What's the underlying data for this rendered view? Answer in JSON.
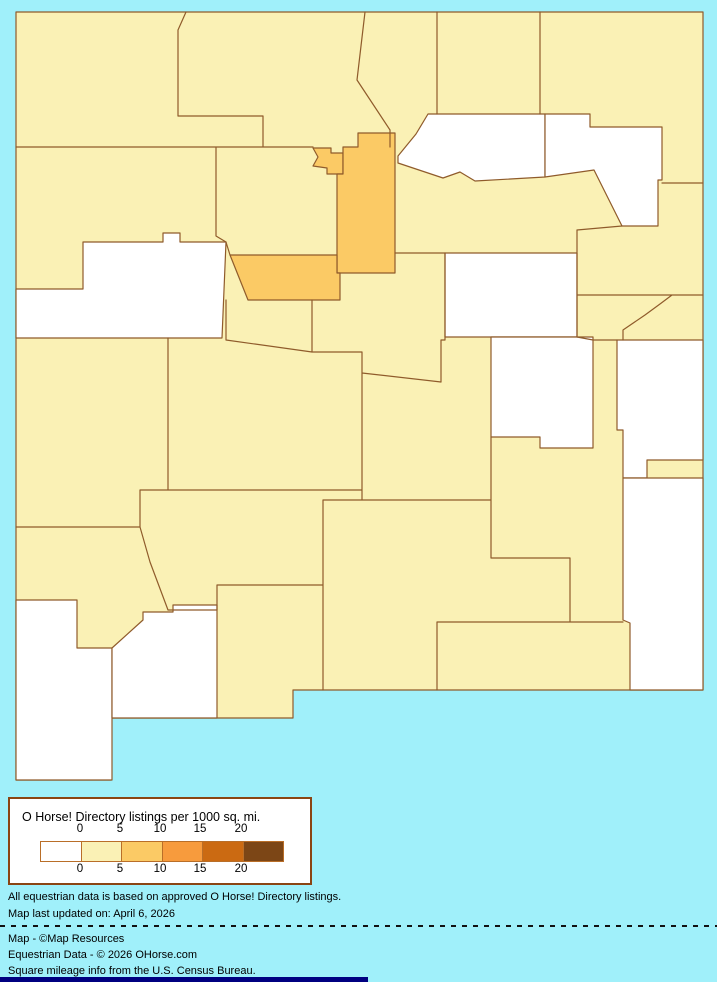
{
  "map": {
    "background_color": "#A0F0FA",
    "border_color": "#8F5B2B",
    "palette": {
      "b0": "#FFFFFF",
      "b1": "#FAF1B5",
      "b2": "#FBCA65",
      "b3": "#F79B3D",
      "b4": "#CB6A12",
      "b5": "#7C4616"
    },
    "regions": {
      "white_bucket": [
        "cibola",
        "mora",
        "harding",
        "guadalupe",
        "de-baca",
        "roosevelt",
        "lea",
        "hidalgo",
        "luna"
      ],
      "light_orange_bucket": [
        "los-alamos",
        "santa-fe",
        "bernalillo"
      ],
      "pale_yellow_bucket": [
        "san-juan",
        "rio-arriba",
        "taos",
        "colfax",
        "union",
        "mckinley",
        "sandoval",
        "san-miguel",
        "quay",
        "curry",
        "valencia",
        "torrance",
        "socorro",
        "lincoln",
        "chaves",
        "catron",
        "sierra",
        "grant",
        "dona-ana",
        "otero",
        "eddy"
      ]
    }
  },
  "legend": {
    "title": "O Horse! Directory listings per 1000 sq. mi.",
    "ticks": [
      "0",
      "5",
      "10",
      "15",
      "20"
    ],
    "swatches": [
      "#FFFFFF",
      "#FAF1B5",
      "#FBCA65",
      "#F79B3D",
      "#CB6A12",
      "#7C4616"
    ]
  },
  "footer": {
    "note1": "All equestrian data is based on approved O Horse! Directory listings.",
    "note2": "Map last updated on: April 6, 2026",
    "credit1": "Map - ©Map Resources",
    "credit2": "Equestrian Data - © 2026 OHorse.com",
    "credit3": "Square mileage info from the U.S. Census Bureau."
  }
}
